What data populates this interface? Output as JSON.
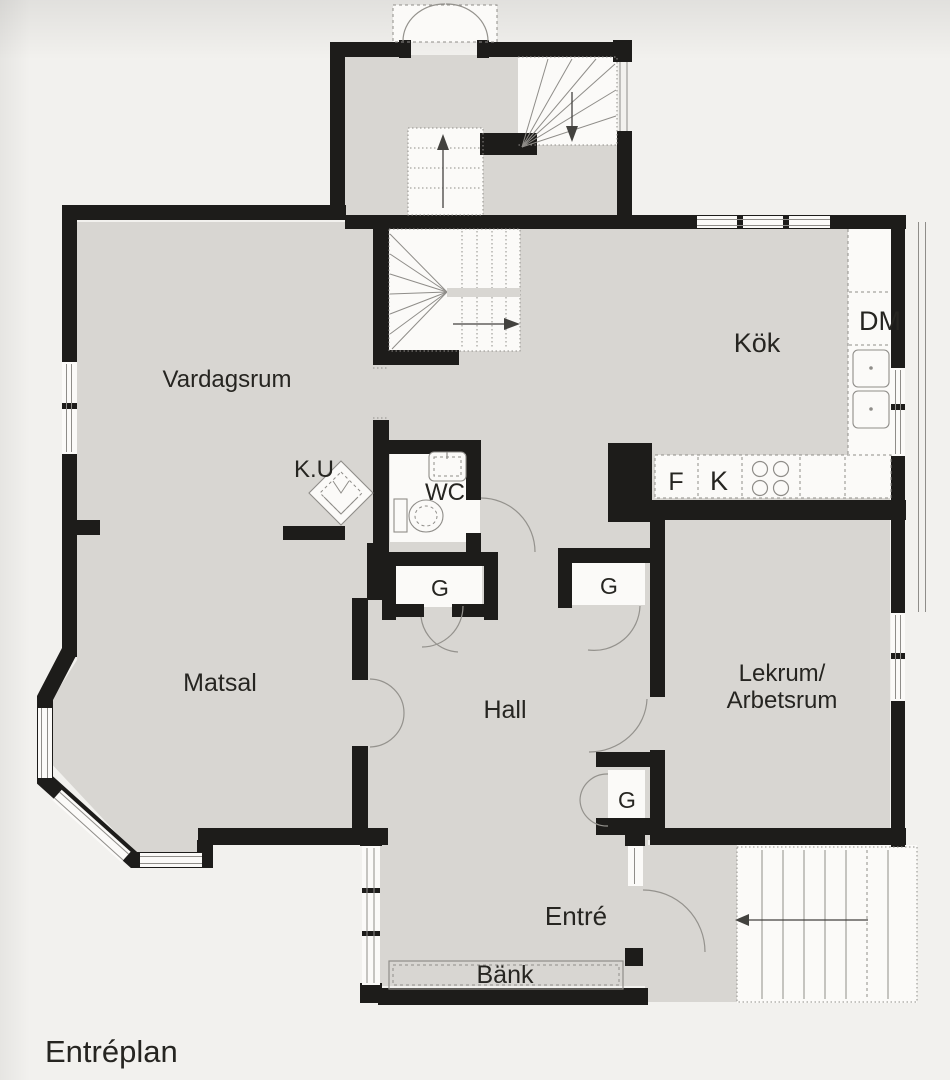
{
  "page": {
    "title": "Entréplan"
  },
  "rooms": {
    "living": "Vardagsrum",
    "kitchen": "Kök",
    "dining": "Matsal",
    "hall": "Hall",
    "wc": "WC",
    "playroom_line1": "Lekrum/",
    "playroom_line2": "Arbetsrum",
    "entry": "Entré"
  },
  "fixtures": {
    "dishwasher": "DM",
    "fridge": "F",
    "freezer": "K",
    "tiled_stove": "K.U",
    "bench": "Bänk",
    "closet": "G"
  },
  "colors": {
    "paper": "#f2f1ee",
    "floor": "#d8d6d2",
    "wall": "#1d1c1a",
    "white": "#fbfaf8",
    "line": "#8f8d89",
    "text": "#262521"
  }
}
